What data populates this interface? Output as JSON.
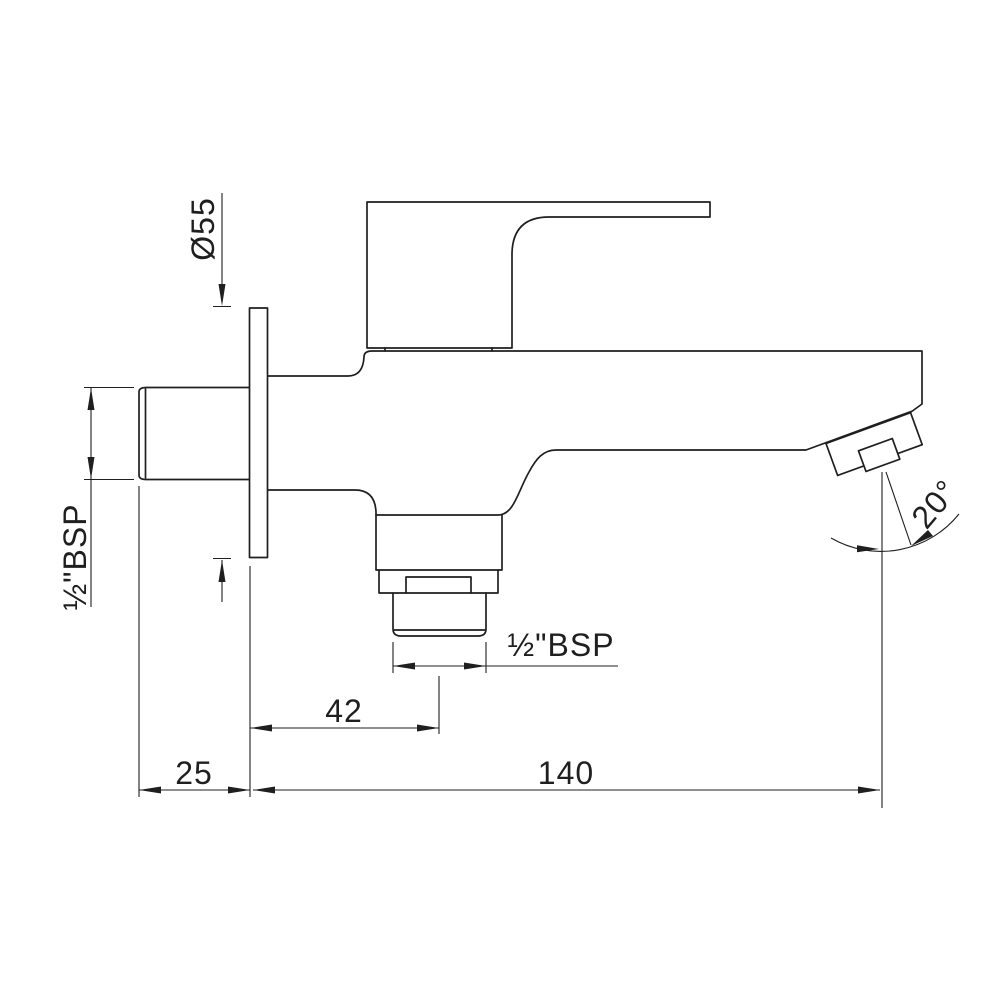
{
  "drawing": {
    "kind": "technical-dimension-drawing",
    "labels": {
      "flange_diameter": "Ø55",
      "inlet_thread": "½\"BSP",
      "outlet_thread": "½\"BSP",
      "outlet_center_offset": "42",
      "wall_distance": "25",
      "spout_reach": "140",
      "spout_angle": "20°"
    },
    "colors": {
      "line": "#1f1f1f",
      "background": "#ffffff"
    }
  }
}
